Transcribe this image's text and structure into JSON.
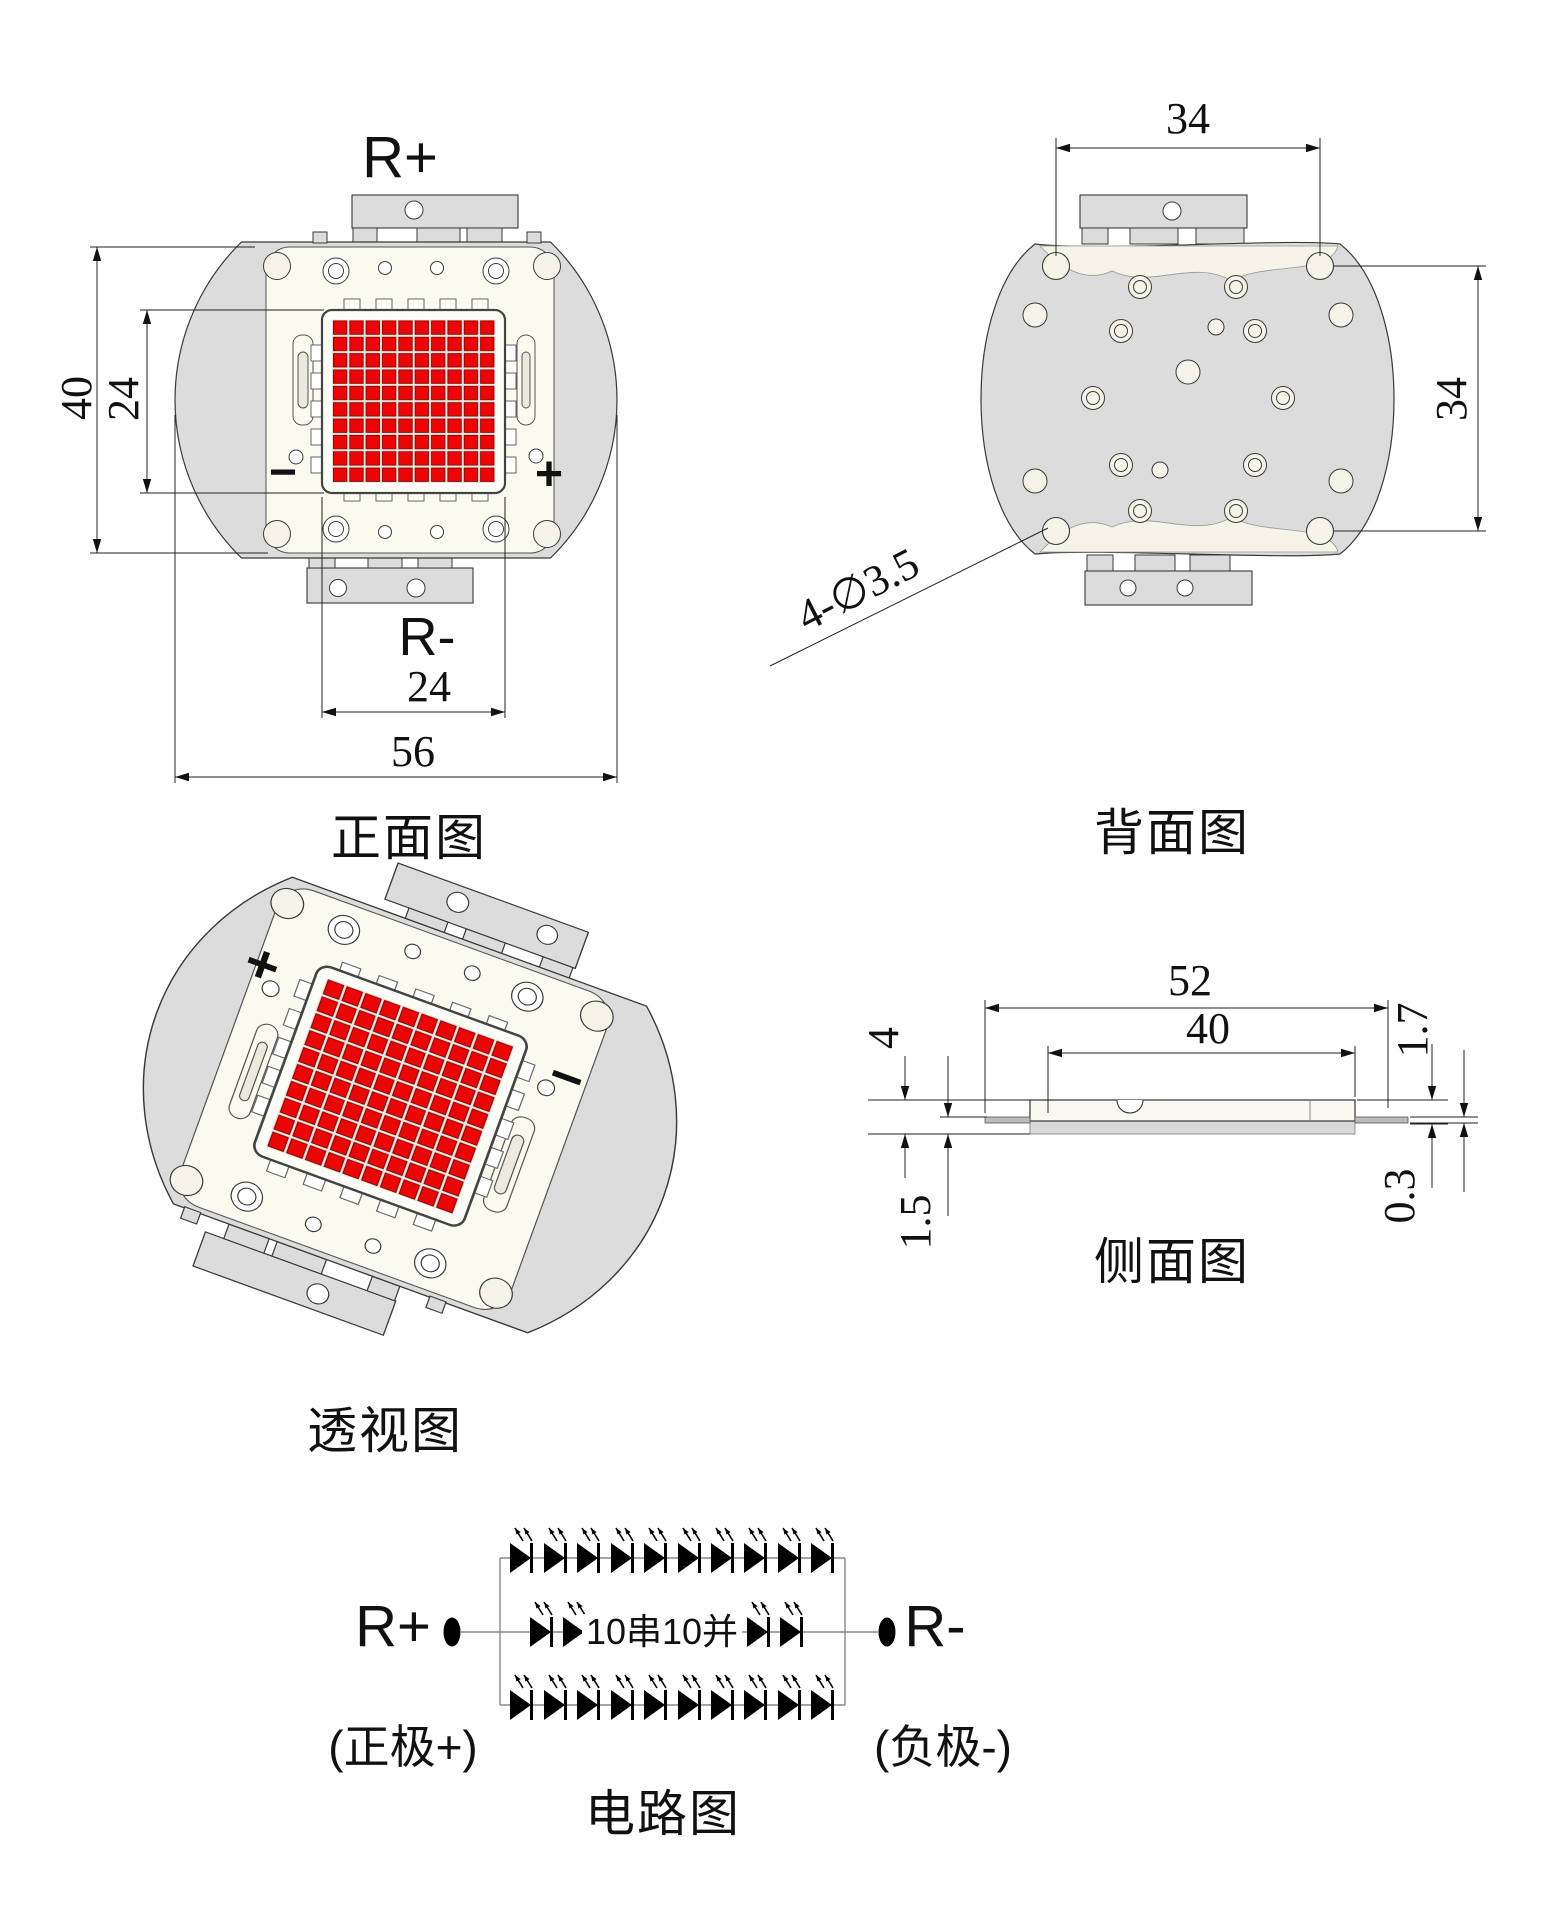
{
  "views": {
    "front": {
      "title": "正面图",
      "top_terminal": "R+",
      "bottom_terminal": "R-",
      "minus_mark": "−",
      "plus_mark": "+",
      "dims": {
        "body_height": "40",
        "emitter_height": "24",
        "emitter_width": "24",
        "body_width": "56"
      }
    },
    "back": {
      "title": "背面图",
      "dims": {
        "hole_span_width": "34",
        "hole_span_height": "34",
        "mounting_holes": "4-∅3.5"
      }
    },
    "perspective": {
      "title": "透视图"
    },
    "side": {
      "title": "侧面图",
      "dims": {
        "substrate_length": "52",
        "ceramic_length": "40",
        "total_thickness": "4",
        "base_thickness": "1.5",
        "top_thickness": "1.7",
        "lead_thickness": "0.3"
      }
    },
    "circuit": {
      "title": "电路图",
      "positive_terminal": "R+",
      "negative_terminal": "R-",
      "topology": "10串10并",
      "series_count": 10,
      "parallel_count": 10,
      "positive_note": "(正极+)",
      "negative_note": "(负极-)"
    }
  },
  "colors": {
    "led_red": "#ec0505",
    "body_gray": "#dcdcdc",
    "plate_cream": "#f6f4e8",
    "line_dark": "#333333"
  }
}
